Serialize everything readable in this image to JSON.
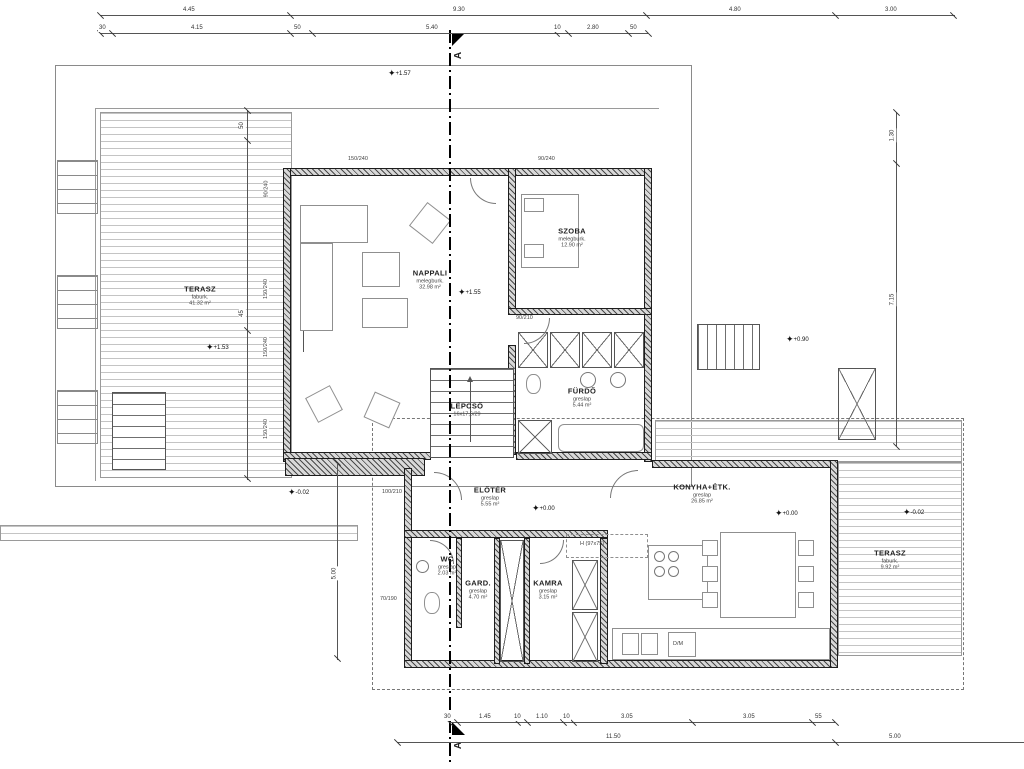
{
  "drawing": {
    "section_marker": "A",
    "rooms": {
      "terasz_felso": {
        "name": "TERASZ",
        "finish": "faburk.",
        "area": "41.32 m²"
      },
      "nappali": {
        "name": "NAPPALI",
        "finish": "melegburk.",
        "area": "32.98 m²"
      },
      "szoba": {
        "name": "SZOBA",
        "finish": "melegburk.",
        "area": "12.90 m²"
      },
      "furdo": {
        "name": "FÜRDŐ",
        "finish": "greslap",
        "area": "5.44 m²"
      },
      "lepcso": {
        "name": "LÉPCSŐ",
        "finish": "16x17,6/29"
      },
      "eloter": {
        "name": "ELŐTÉR",
        "finish": "greslap",
        "area": "5.55 m²"
      },
      "wc": {
        "name": "WC",
        "finish": "greslap",
        "area": "2.03 m²"
      },
      "gard": {
        "name": "GARD.",
        "finish": "greslap",
        "area": "4.70 m²"
      },
      "kamra": {
        "name": "KAMRA",
        "finish": "greslap",
        "area": "3.15 m²"
      },
      "konyha": {
        "name": "KONYHA+ÉTK.",
        "finish": "greslap",
        "area": "26.85 m²"
      },
      "terasz_also": {
        "name": "TERASZ",
        "finish": "faburk.",
        "area": "9.92 m²"
      }
    },
    "levels": {
      "a": "+1.57",
      "b": "+1.53",
      "c": "+1.55",
      "d": "+0.90",
      "e": "+0.00",
      "f": "+0.00",
      "g": "-0.02",
      "h": "-0.02"
    },
    "dims": {
      "top1": [
        "4.45",
        "9.30",
        "4.80",
        "3.00"
      ],
      "top2": [
        "30",
        "4.15",
        "50",
        "5.40",
        "10",
        "2.80",
        "50"
      ],
      "bottom1": [
        "30",
        "1.45",
        "10",
        "1.10",
        "10",
        "3.05",
        "3.05",
        "55"
      ],
      "bottom2": [
        "11.50",
        "5.00"
      ],
      "right": [
        "1.30",
        "7.15"
      ],
      "left": [
        "50",
        "45",
        "5.00"
      ],
      "windows": [
        "90/240",
        "150/240",
        "150/240",
        "150/240",
        "150/240",
        "90/240",
        "90/210",
        "70/190",
        "100/210"
      ]
    },
    "labels": {
      "appliance": "H (97x75)",
      "dm": "D/M"
    }
  }
}
